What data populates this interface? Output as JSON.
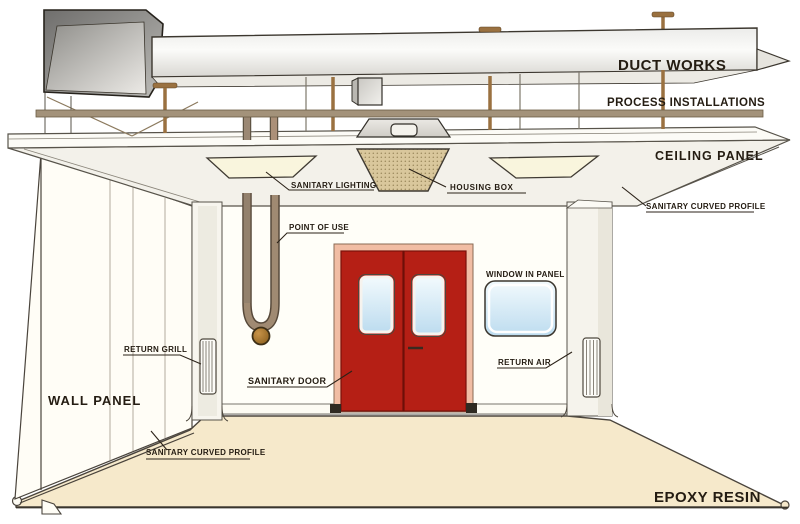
{
  "labels": {
    "duct_works": "DUCT WORKS",
    "process_installations": "PROCESS INSTALLATIONS",
    "ceiling_panel": "CEILING PANEL",
    "sanitary_curved_profile_ceiling": "SANITARY CURVED PROFILE",
    "sanitary_lighting": "SANITARY LIGHTING",
    "housing_box": "HOUSING BOX",
    "point_of_use": "POINT OF USE",
    "window_in_panel": "WINDOW IN PANEL",
    "return_air": "RETURN AIR",
    "return_grill": "RETURN GRILL",
    "sanitary_door": "SANITARY DOOR",
    "wall_panel": "WALL PANEL",
    "sanitary_curved_profile_floor": "SANITARY CURVED PROFILE",
    "epoxy_resin": "EPOXY RESIN"
  },
  "colors": {
    "door_red": "#b51f15",
    "door_frame": "#f1bda4",
    "floor": "#f6e9cb",
    "pipe_brown": "#9a7140",
    "pipe_rack": "#a3927a",
    "housing_box_fill": "#d9c79c",
    "light_panel": "#f9f5dd",
    "label_text": "#241c12"
  }
}
